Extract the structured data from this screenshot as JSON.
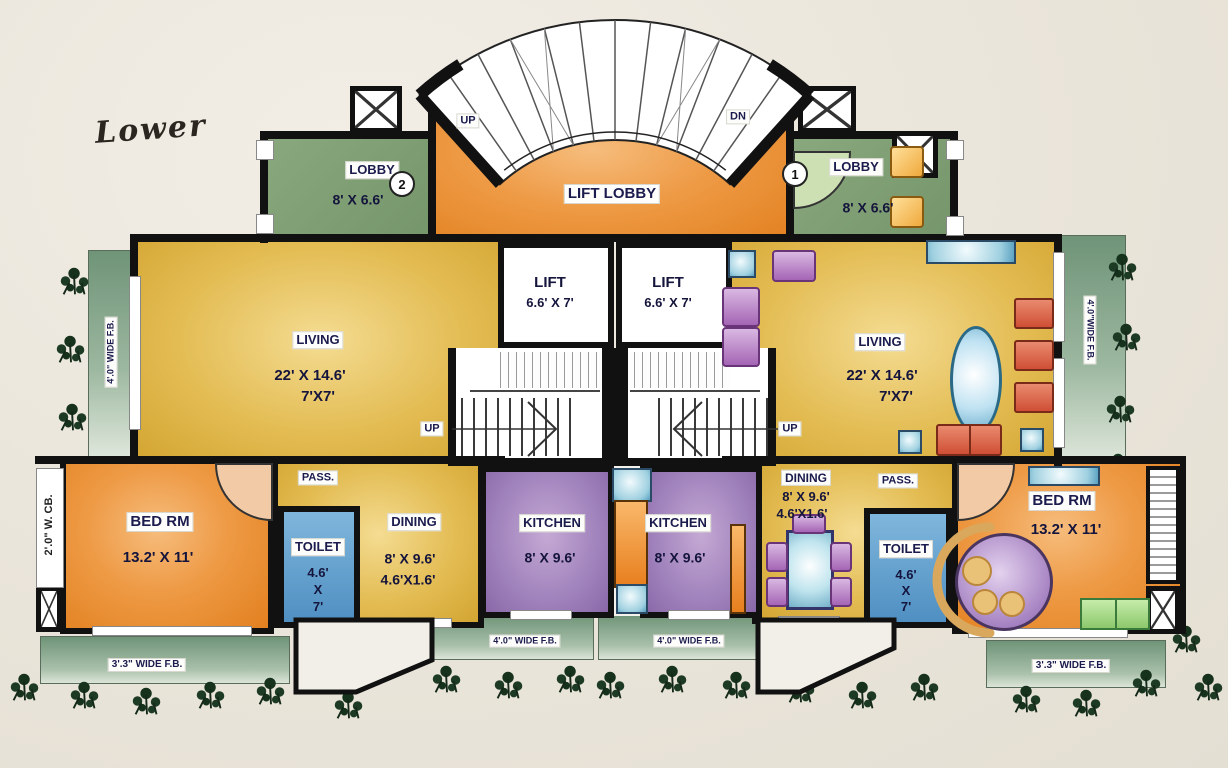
{
  "title": "Lower",
  "stairs": {
    "up_top": "UP",
    "dn_top": "DN",
    "up_mid_left": "UP",
    "up_mid_right": "UP"
  },
  "rooms": {
    "lift_lobby": {
      "label": "LIFT LOBBY"
    },
    "lobby_left": {
      "label": "LOBBY",
      "dims": "8' X 6.6'",
      "unit_no": "2"
    },
    "lobby_right": {
      "label": "LOBBY",
      "dims": "8' X 6.6'",
      "unit_no": "1"
    },
    "lift_left": {
      "label": "LIFT",
      "dims": "6.6' X 7'"
    },
    "lift_right": {
      "label": "LIFT",
      "dims": "6.6' X 7'"
    },
    "living_left": {
      "label": "LIVING",
      "dims": "22' X 14.6'",
      "dims2": "7'X7'"
    },
    "living_right": {
      "label": "LIVING",
      "dims": "22' X 14.6'",
      "dims2": "7'X7'"
    },
    "pass_left": {
      "label": "PASS."
    },
    "pass_right": {
      "label": "PASS."
    },
    "bed_left": {
      "label": "BED  RM",
      "dims": "13.2' X 11'"
    },
    "bed_right": {
      "label": "BED  RM",
      "dims": "13.2' X 11'"
    },
    "toilet_left": {
      "label": "TOILET",
      "dim_w": "4.6'",
      "dim_x": "X",
      "dim_h": "7'"
    },
    "toilet_right": {
      "label": "TOILET",
      "dim_w": "4.6'",
      "dim_x": "X",
      "dim_h": "7'"
    },
    "dining_left": {
      "label": "DINING",
      "dims": "8' X 9.6'",
      "dims2": "4.6'X1.6'"
    },
    "dining_right": {
      "label": "DINING",
      "dims": "8' X 9.6'",
      "dims2": "4.6'X1.6'"
    },
    "kitchen_left": {
      "label": "KITCHEN",
      "dims": "8' X 9.6'"
    },
    "kitchen_right": {
      "label": "KITCHEN",
      "dims": "8' X 9.6'"
    }
  },
  "balconies": {
    "left_side": "4'.0\" WIDE F.B.",
    "right_side": "4'.0\"WIDE F.B.",
    "bottom_left": "3'.3\" WIDE F.B.",
    "bottom_center_left": "4'.0\" WIDE F.B.",
    "bottom_center_right": "4'.0\" WIDE F.B.",
    "bottom_right": "3'.3\" WIDE F.B.",
    "wardrobe_chajja": "2'.0\" W. CB."
  },
  "colors": {
    "background": "#ece8df",
    "wall": "#111111",
    "orange_room": "#e8872f",
    "living_gold": "#d9ae3a",
    "lobby_green": "#7d9c72",
    "balcony_green": "#86a88c",
    "kitchen_purple": "#9677b4",
    "toilet_blue": "#5b9cc8",
    "label_navy": "#1b1b4e"
  }
}
